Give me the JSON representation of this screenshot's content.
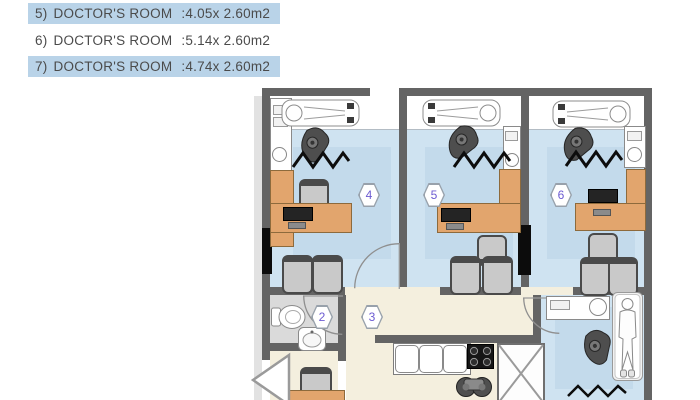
{
  "legend": {
    "items": [
      {
        "no": "5)",
        "name": "DOCTOR'S ROOM",
        "size": ":4.05x 2.60m2",
        "highlighted": true
      },
      {
        "no": "6)",
        "name": "DOCTOR'S ROOM",
        "size": ":5.14x 2.60m2",
        "highlighted": false
      },
      {
        "no": "7)",
        "name": "DOCTOR'S ROOM",
        "size": ":4.74x 2.60m2",
        "highlighted": true
      }
    ]
  },
  "plan": {
    "badges": {
      "wc": "2",
      "hall": "3",
      "room4": "4",
      "room5": "5",
      "room6": "6"
    },
    "icons": [
      "dental-chair",
      "dental-unit",
      "zigzag-separator",
      "desk",
      "monitor",
      "office-chair",
      "waiting-chair",
      "sink",
      "washbasin",
      "toilet",
      "stove",
      "wheelchair",
      "shaft-cross",
      "door-arc",
      "entrance-arrow",
      "patient-bed",
      "room-number-hexagon",
      "wall-column"
    ]
  },
  "colors": {
    "legend_highlight": "#b9d3e8",
    "legend_text": "#4b4b4b",
    "wall": "#646464",
    "floor_blue": "#cfe3f1",
    "floor_beige": "#f4efde",
    "floor_gray": "#dadada",
    "furniture_orange": "#e2a56d",
    "equipment_gray": "#4e4e4e",
    "badge_number": "#6c5bd2"
  }
}
